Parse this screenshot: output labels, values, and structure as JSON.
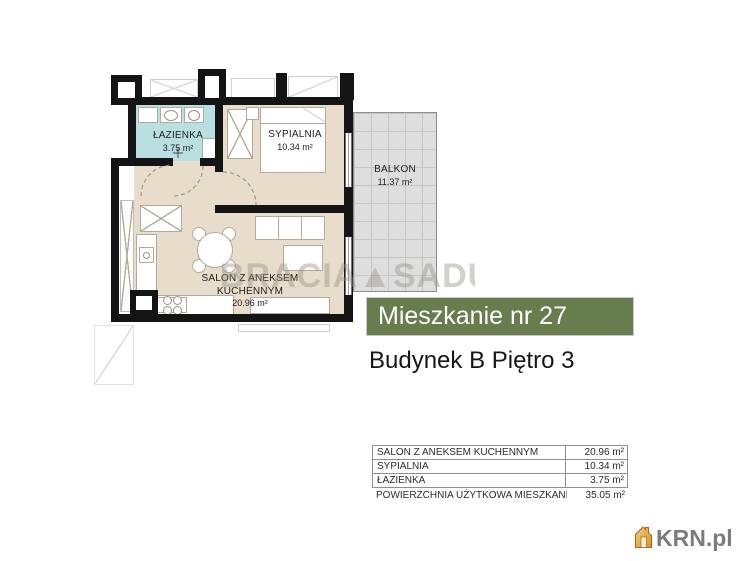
{
  "plan": {
    "rooms": {
      "bathroom": {
        "name": "ŁAZIENKA",
        "area": "3.75 m²"
      },
      "bedroom": {
        "name": "SYPIALNIA",
        "area": "10.34 m²"
      },
      "balcony": {
        "name": "BALKON",
        "area": "11.37 m²"
      },
      "salon": {
        "name": "SALON Z ANEKSEM KUCHENNYM",
        "area": "20.96 m²"
      }
    },
    "watermark": "BRACIA▲SADU"
  },
  "banner": {
    "title": "Mieszkanie nr 27",
    "bg_color": "#687d4e"
  },
  "subtitle": "Budynek B Piętro 3",
  "area_table": {
    "rows": [
      {
        "label": "SALON Z ANEKSEM KUCHENNYM",
        "value": "20.96 m²"
      },
      {
        "label": "SYPIALNIA",
        "value": "10.34 m²"
      },
      {
        "label": "ŁAZIENKA",
        "value": "3.75 m²"
      },
      {
        "label": "POWIERZCHNIA UŻYTKOWA MIESZKANIA",
        "value": "35.05 m²"
      }
    ]
  },
  "footer_logo": {
    "text": "KRN.pl"
  },
  "colors": {
    "banner_green": "#687d4e",
    "apartment_floor": "#e8dcca",
    "bathroom_floor": "#b9dfe1",
    "balcony_tile": "#dedede",
    "wall": "#141414",
    "logo_house_orange": "#e8a23c"
  }
}
